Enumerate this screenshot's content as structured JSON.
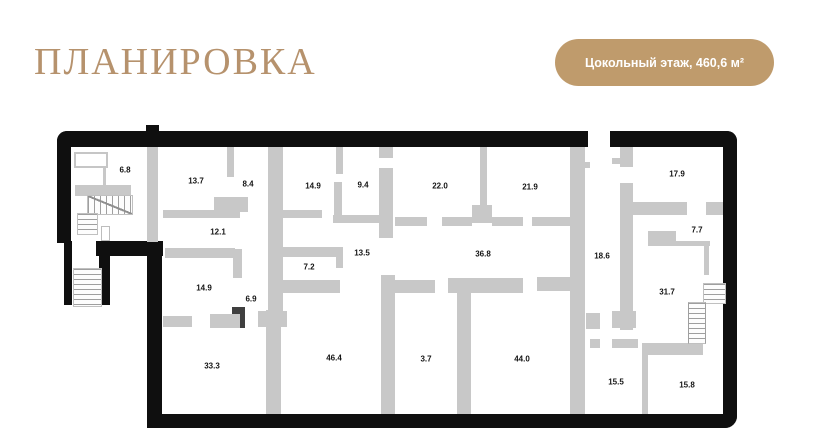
{
  "page": {
    "bg": "#ffffff"
  },
  "header": {
    "title": "ПЛАНИРОВКА",
    "title_color": "#b6926d"
  },
  "badge": {
    "label": "Цокольный этаж, 460,6 м²",
    "bg_color": "#bf9b6c",
    "text_color": "#ffffff"
  },
  "plan": {
    "exterior_wall_color": "#0f0f0f",
    "partition_color": "#c8c8c8",
    "room_label_color": "#141414",
    "rooms": [
      {
        "area": "6.8",
        "x": 125,
        "y": 170
      },
      {
        "area": "13.7",
        "x": 196,
        "y": 181
      },
      {
        "area": "8.4",
        "x": 248,
        "y": 184
      },
      {
        "area": "14.9",
        "x": 313,
        "y": 186
      },
      {
        "area": "9.4",
        "x": 363,
        "y": 185
      },
      {
        "area": "22.0",
        "x": 440,
        "y": 186
      },
      {
        "area": "21.9",
        "x": 530,
        "y": 187
      },
      {
        "area": "17.9",
        "x": 677,
        "y": 174
      },
      {
        "area": "12.1",
        "x": 218,
        "y": 232
      },
      {
        "area": "13.5",
        "x": 362,
        "y": 253
      },
      {
        "area": "36.8",
        "x": 483,
        "y": 254
      },
      {
        "area": "18.6",
        "x": 602,
        "y": 256
      },
      {
        "area": "7.7",
        "x": 697,
        "y": 230
      },
      {
        "area": "7.2",
        "x": 309,
        "y": 267
      },
      {
        "area": "14.9",
        "x": 204,
        "y": 288
      },
      {
        "area": "6.9",
        "x": 251,
        "y": 299
      },
      {
        "area": "31.7",
        "x": 667,
        "y": 292
      },
      {
        "area": "33.3",
        "x": 212,
        "y": 366
      },
      {
        "area": "46.4",
        "x": 334,
        "y": 358
      },
      {
        "area": "3.7",
        "x": 426,
        "y": 359
      },
      {
        "area": "44.0",
        "x": 522,
        "y": 359
      },
      {
        "area": "15.5",
        "x": 616,
        "y": 382
      },
      {
        "area": "15.8",
        "x": 687,
        "y": 385
      }
    ]
  }
}
